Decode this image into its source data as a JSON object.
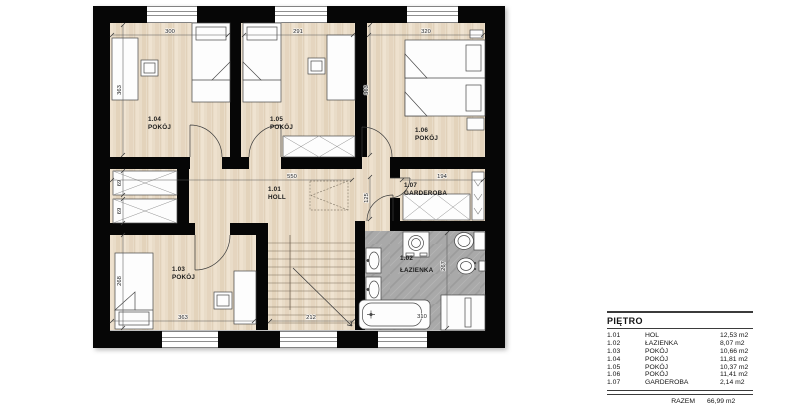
{
  "plan": {
    "rooms": {
      "holl": {
        "id": "1.01",
        "name": "HOLL"
      },
      "lazienka": {
        "id": "1.02",
        "name": "ŁAZIENKA"
      },
      "pokoj103": {
        "id": "1.03",
        "name": "POKÓJ"
      },
      "pokoj104": {
        "id": "1.04",
        "name": "POKÓJ"
      },
      "pokoj105": {
        "id": "1.05",
        "name": "POKÓJ"
      },
      "pokoj106": {
        "id": "1.06",
        "name": "POKÓJ"
      },
      "garderoba": {
        "id": "1.07",
        "name": "GARDEROBA"
      }
    },
    "dims": {
      "w104": "300",
      "w105": "291",
      "w106": "320",
      "h104": "363",
      "h106": "363",
      "niche_top": "69",
      "niche_bottom": "69",
      "h103": "268",
      "holl_w": "550",
      "vestibule_h": "125",
      "gard_w": "194",
      "w103": "363",
      "stairs_w": "212",
      "tub_w": "310",
      "bath_h": "267"
    }
  },
  "legend": {
    "title": "PIĘTRO",
    "rows": [
      {
        "id": "1.01",
        "name": "HOL",
        "area": "12,53 m2"
      },
      {
        "id": "1.02",
        "name": "ŁAZIENKA",
        "area": "8,07 m2"
      },
      {
        "id": "1.03",
        "name": "POKÓJ",
        "area": "10,66 m2"
      },
      {
        "id": "1.04",
        "name": "POKÓJ",
        "area": "11,81 m2"
      },
      {
        "id": "1.05",
        "name": "POKÓJ",
        "area": "10,37 m2"
      },
      {
        "id": "1.06",
        "name": "POKÓJ",
        "area": "11,41 m2"
      },
      {
        "id": "1.07",
        "name": "GARDEROBA",
        "area": "2,14 m2"
      }
    ],
    "total_label": "RAZEM",
    "total_area": "66,99 m2"
  },
  "colors": {
    "wall": "#060606",
    "floor_wood": "#e9dcc8",
    "floor_bath": "#a9a9a9",
    "line": "#3c3c3c"
  }
}
